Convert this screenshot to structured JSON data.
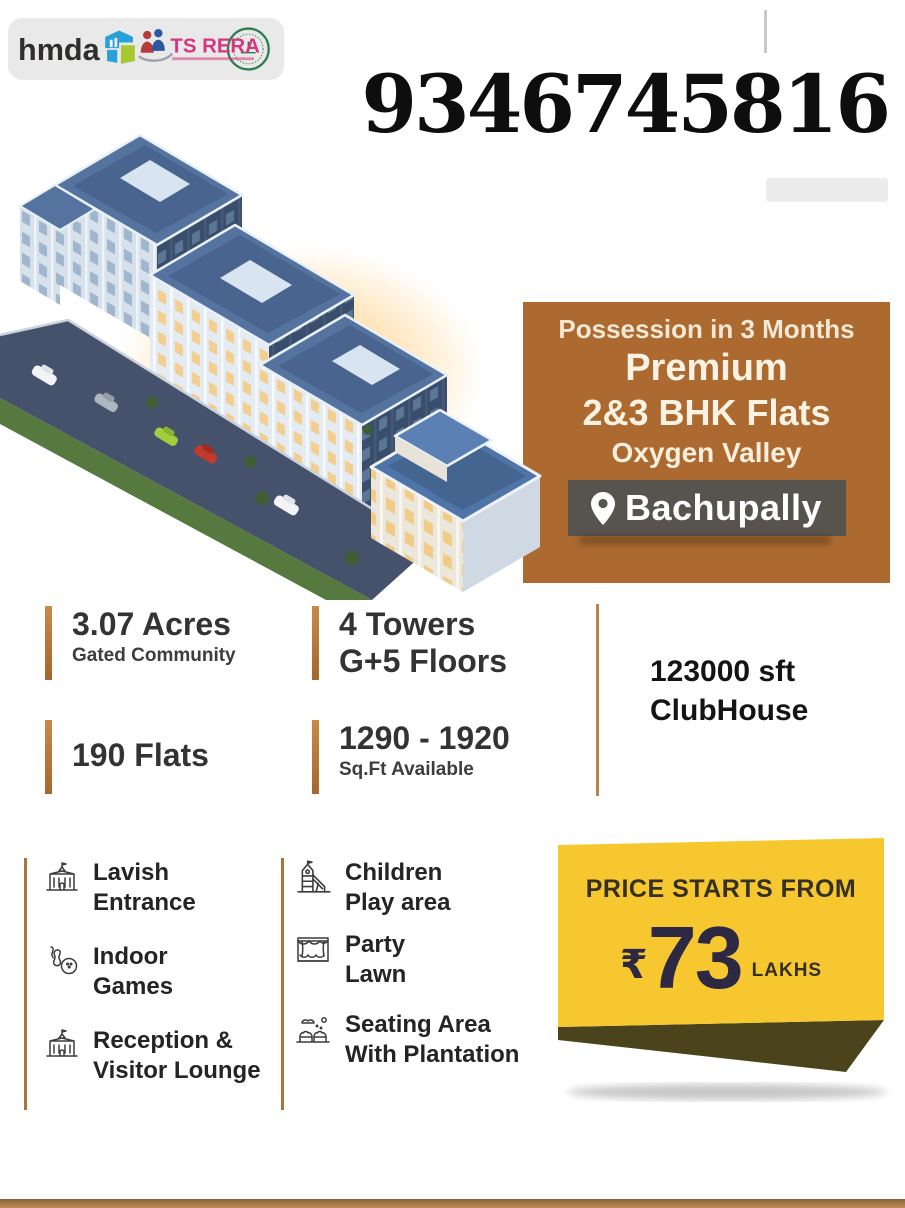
{
  "colors": {
    "offer_brown": "#ad6a30",
    "location_band": "#57544d",
    "stat_bar_brown": "#b5773a",
    "price_yellow": "#f7c72f",
    "price_navy": "#2d2844",
    "ribbon_olive": "#4a431c",
    "logo_plate_gray": "#e9e9e9",
    "rera_pink": "#d6367f",
    "rera_green": "#2e7d4f"
  },
  "logos": {
    "hmda": "hmda",
    "rera": "TS RERA"
  },
  "phone": "9346745816",
  "offer": {
    "possession": "Possession in 3 Months",
    "premium": "Premium",
    "bhk": "2&3 BHK Flats",
    "project": "Oxygen Valley",
    "location": "Bachupally"
  },
  "stats": [
    {
      "big": "3.07 Acres",
      "small": "Gated Community"
    },
    {
      "big": "4 Towers",
      "big2": "G+5 Floors"
    },
    {
      "big": "190 Flats"
    },
    {
      "big": "1290 - 1920",
      "small": "Sq.Ft Available"
    }
  ],
  "clubhouse": {
    "line1": "123000 sft",
    "line2": "ClubHouse"
  },
  "amenities": {
    "col1": [
      {
        "icon": "entrance-icon",
        "line1": "Lavish",
        "line2": "Entrance"
      },
      {
        "icon": "bowling-icon",
        "line1": "Indoor",
        "line2": "Games"
      },
      {
        "icon": "reception-icon",
        "line1": "Reception &",
        "line2": "Visitor Lounge"
      }
    ],
    "col2": [
      {
        "icon": "playground-icon",
        "line1": "Children",
        "line2": "Play area"
      },
      {
        "icon": "party-lawn-icon",
        "line1": "Party",
        "line2": "Lawn"
      },
      {
        "icon": "seating-icon",
        "line1": "Seating Area",
        "line2": "With Plantation"
      }
    ]
  },
  "price": {
    "heading": "PRICE STARTS FROM",
    "currency": "₹",
    "amount": "73",
    "unit": "LAKHS"
  }
}
